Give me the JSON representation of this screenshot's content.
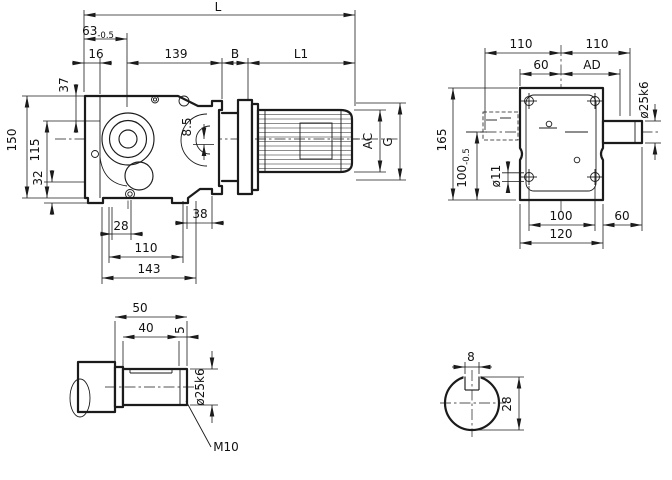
{
  "colors": {
    "line": "#1b1b1b",
    "bg": "#ffffff"
  },
  "side_view": {
    "dims": {
      "L": "L",
      "d63": {
        "v": "63",
        "tol": "-0.5"
      },
      "d16": "16",
      "d139": "139",
      "B": "B",
      "L1": "L1",
      "d37": "37",
      "d150": "150",
      "d115": "115",
      "d32": "32",
      "d8_5": "8.5",
      "d28": "28",
      "d38": "38",
      "d110": "110",
      "d143": "143",
      "AC": "AC",
      "G": "G"
    }
  },
  "end_view": {
    "dims": {
      "d110_left": "110",
      "d110_right": "110",
      "d60_top": "60",
      "AD": "AD",
      "d25k6": "ø25k6",
      "d165": "165",
      "d100": {
        "v": "100",
        "tol": "-0.5"
      },
      "d11": "ø11",
      "d100_bottom": "100",
      "d120": "120",
      "d60_bottom": "60"
    }
  },
  "shaft_detail": {
    "dims": {
      "d50": "50",
      "d40": "40",
      "d5": "5",
      "d25k6": "ø25k6",
      "thread": "M10"
    }
  },
  "key_section": {
    "dims": {
      "d8": "8",
      "d28": "28"
    }
  }
}
